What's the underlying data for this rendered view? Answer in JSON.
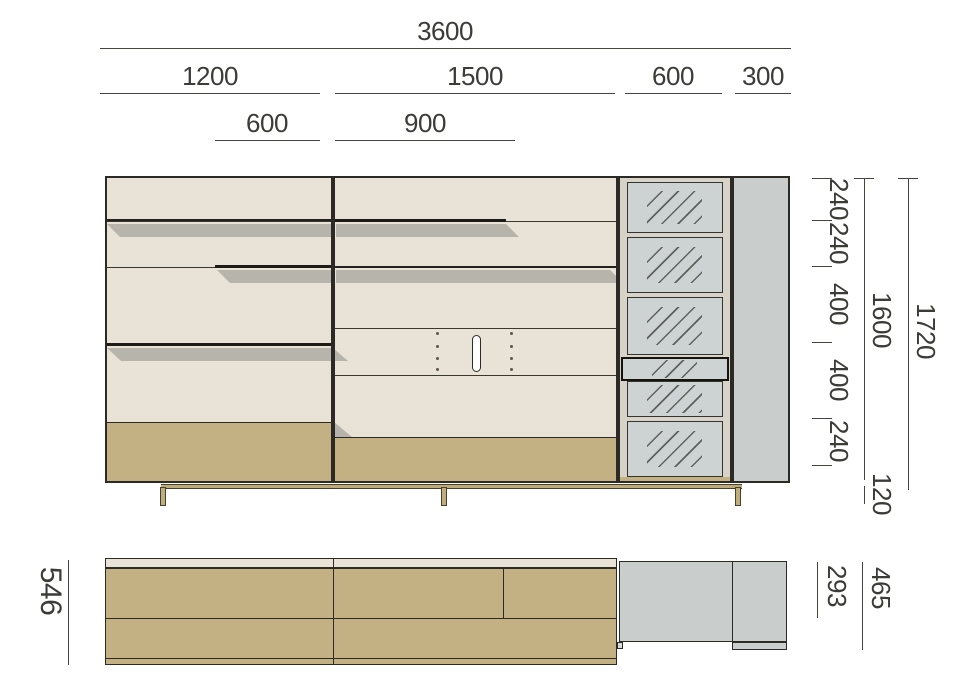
{
  "drawing": {
    "front": {
      "top_dims": {
        "total": "3600",
        "sections": [
          "1200",
          "1500",
          "600",
          "300"
        ],
        "inner": [
          "600",
          "900"
        ]
      },
      "right_dims": {
        "chain": [
          "240",
          "240",
          "400",
          "400",
          "240"
        ],
        "carcass_height": "1600",
        "plinth_height": "120",
        "overall_height": "1720"
      }
    },
    "plan": {
      "dims": {
        "total_depth": "546",
        "upper_depth": "293",
        "base_depth": "465"
      }
    },
    "colors": {
      "panel_cream": "#e9e2d6",
      "base_tan": "#c4b183",
      "glass_gray": "#cdd3d2",
      "side_gray": "#c9cdcc",
      "frame_greige": "#d8d3c9",
      "shadow": "#b7b4ac",
      "line_dark": "#2c2a24",
      "dim_line": "#45433e",
      "dim_text": "#3b3b38"
    }
  }
}
